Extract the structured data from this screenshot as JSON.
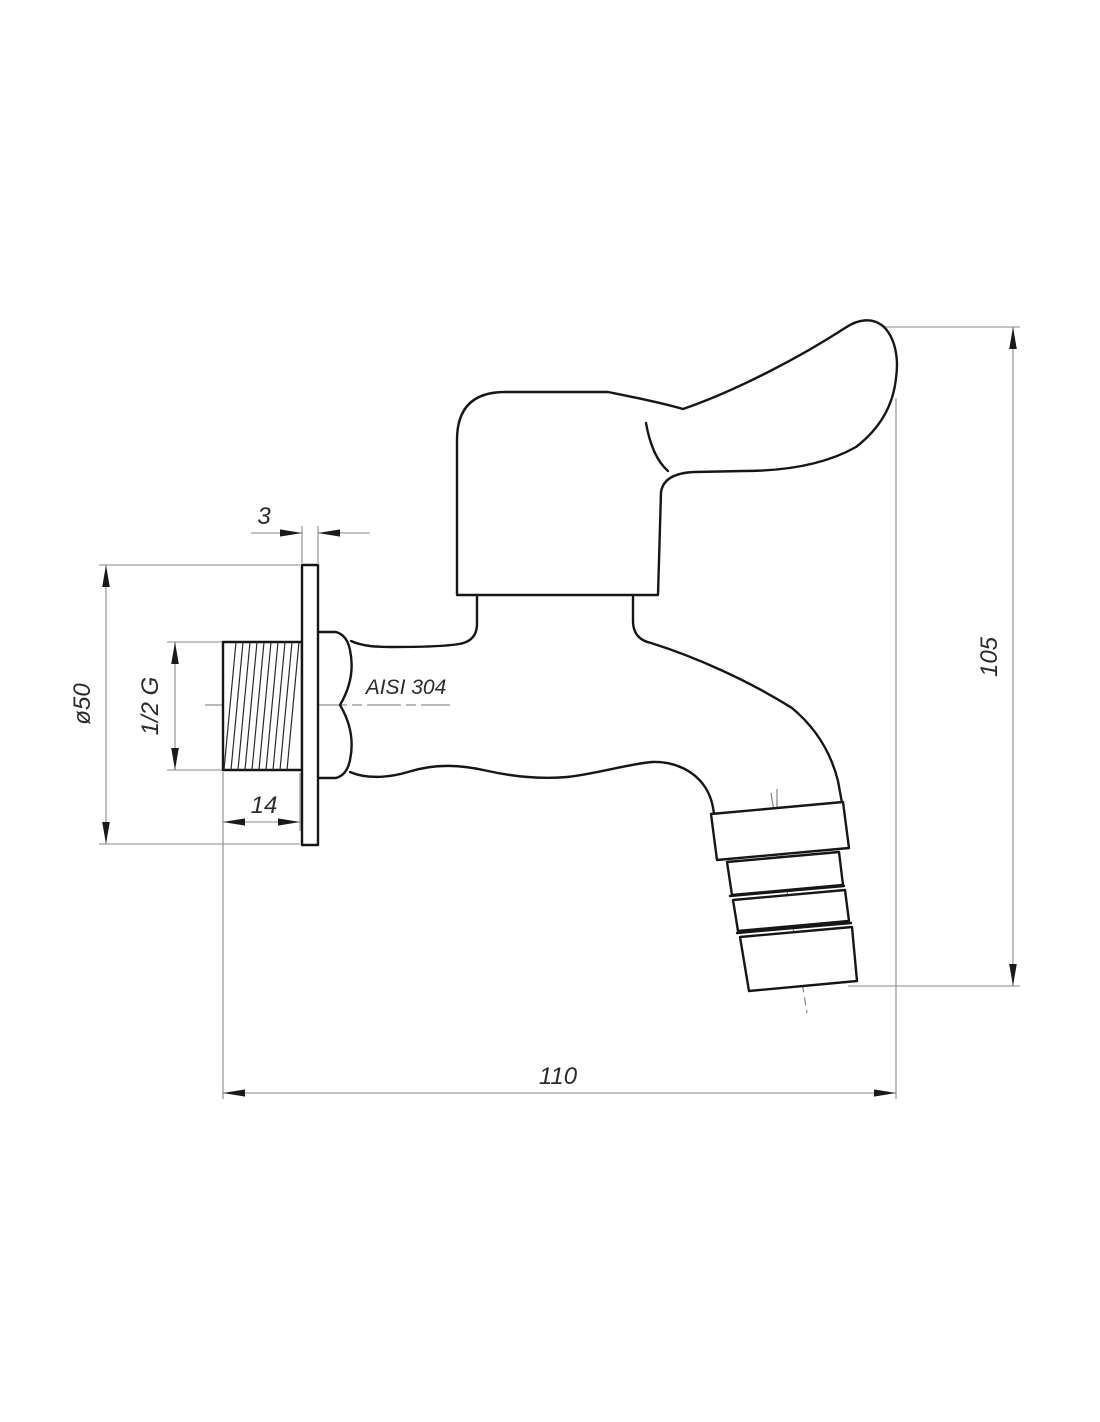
{
  "drawing": {
    "type": "technical-drawing",
    "subject": "wall-mounted tap with hose barb outlet",
    "background_color": "#ffffff",
    "object_line_color": "#161616",
    "dimension_line_color": "#8a8a8a",
    "text_color": "#2b2b2b",
    "material_label": "AISI 304",
    "dimensions": {
      "flange_thickness": "3",
      "flange_diameter": "ø50",
      "thread_size": "1/2 G",
      "thread_length": "14",
      "overall_height": "105",
      "overall_length": "110"
    }
  }
}
